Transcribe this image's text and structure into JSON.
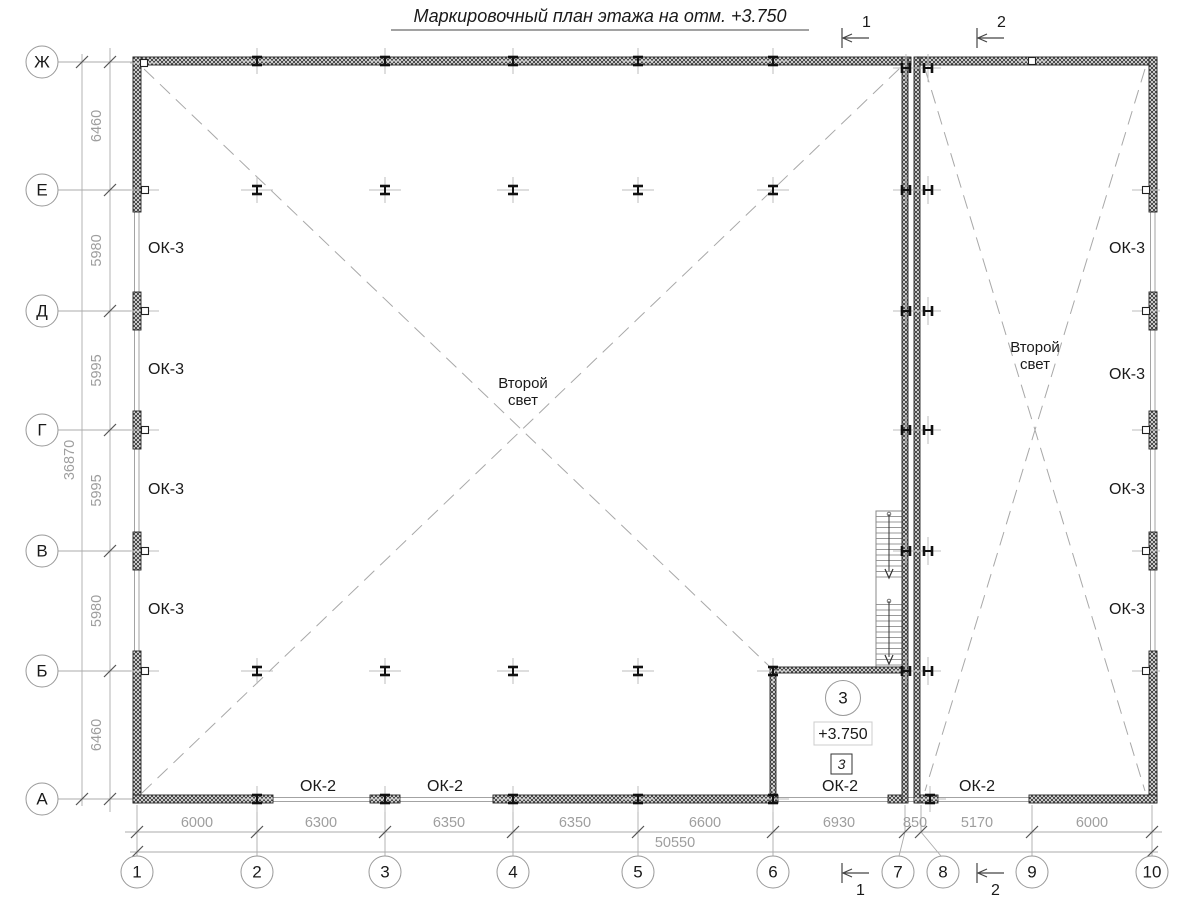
{
  "title": "Маркировочный план этажа на отм. +3.750",
  "axes": {
    "rows": [
      "Ж",
      "Е",
      "Д",
      "Г",
      "В",
      "Б",
      "А"
    ],
    "cols": [
      "1",
      "2",
      "3",
      "4",
      "5",
      "6",
      "7",
      "8",
      "9",
      "10"
    ]
  },
  "dims": {
    "left": [
      "6460",
      "5980",
      "5995",
      "5995",
      "5980",
      "6460"
    ],
    "left_total": "36870",
    "bottom": [
      "6000",
      "6300",
      "6350",
      "6350",
      "6600",
      "6930",
      "850",
      "5170",
      "6000"
    ],
    "bottom_total": "50550"
  },
  "sections": {
    "one": "1",
    "two": "2"
  },
  "labels": {
    "ok3": "ОК-3",
    "ok2": "ОК-2",
    "second_light_line1": "Второй",
    "second_light_line2": "свет"
  },
  "room": {
    "number": "3",
    "elevation": "+3.750",
    "tag": "3"
  },
  "colors": {
    "wall": "#1a1a1a",
    "dim_text": "#9e9e9e",
    "grid_line": "#aaaaaa",
    "hatch": "#333333"
  }
}
